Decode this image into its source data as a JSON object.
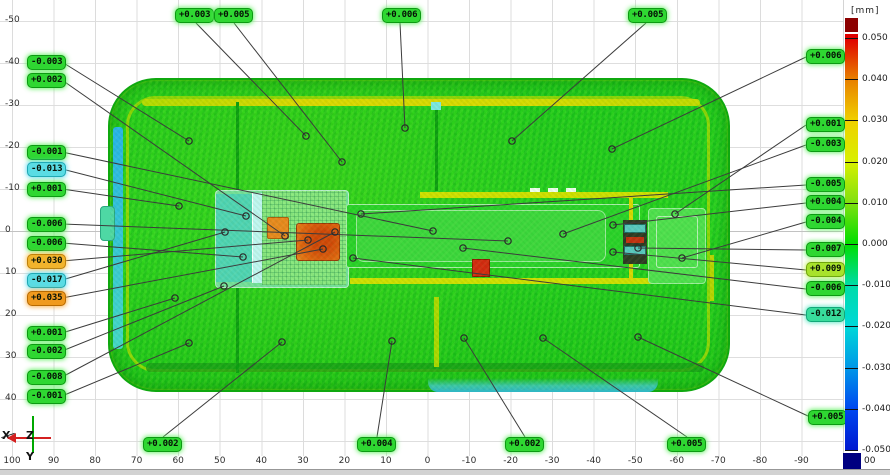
{
  "unit_label": "[mm]",
  "colorbar": {
    "tick_labels": [
      "0.050",
      "0.040",
      "0.030",
      "0.020",
      "0.010",
      "0.000",
      "-0.010",
      "-0.020",
      "-0.030",
      "-0.040",
      "-0.050"
    ],
    "gradient_stops": [
      "#e00000",
      "#e88000",
      "#f0d000",
      "#d8f000",
      "#80e010",
      "#00de00",
      "#00dca8",
      "#00d8d8",
      "#0098e8",
      "#0048f0",
      "#0018d0"
    ],
    "over_color": "#8c0000",
    "under_color": "#000080",
    "under_partial_label": "00"
  },
  "axes": {
    "x_ticks": [
      "100",
      "90",
      "80",
      "70",
      "60",
      "50",
      "40",
      "30",
      "20",
      "10",
      "0",
      "-10",
      "-20",
      "-30",
      "-40",
      "-50",
      "-60",
      "-70",
      "-80",
      "-90"
    ],
    "y_ticks": [
      "-50",
      "-40",
      "-30",
      "-20",
      "-10",
      "0",
      "10",
      "20",
      "30",
      "40"
    ]
  },
  "triad": {
    "x_label": "X",
    "y_label": "Y",
    "z_label": "Z",
    "x_color": "#d42020",
    "y_color": "#00a800"
  },
  "label_colors": {
    "green": "#2fd732",
    "cyan": "#5adce4",
    "teal": "#38dc9c",
    "amber": "#f2b42c",
    "orange": "#f09a1e",
    "lime": "#a8e22c"
  },
  "annotations": [
    {
      "text": "+0.003",
      "c": "green",
      "box": [
        175,
        8
      ],
      "anchor": [
        196,
        23
      ],
      "point": [
        306,
        136
      ]
    },
    {
      "text": "+0.005",
      "c": "green",
      "box": [
        214,
        8
      ],
      "anchor": [
        234,
        23
      ],
      "point": [
        342,
        162
      ]
    },
    {
      "text": "+0.006",
      "c": "green",
      "box": [
        382,
        8
      ],
      "anchor": [
        400,
        23
      ],
      "point": [
        405,
        128
      ]
    },
    {
      "text": "+0.005",
      "c": "green",
      "box": [
        628,
        8
      ],
      "anchor": [
        646,
        23
      ],
      "point": [
        512,
        141
      ]
    },
    {
      "text": "+0.006",
      "c": "green",
      "box": [
        806,
        49
      ],
      "anchor": [
        806,
        57
      ],
      "point": [
        612,
        149
      ]
    },
    {
      "text": "+0.001",
      "c": "green",
      "box": [
        806,
        117
      ],
      "anchor": [
        806,
        125
      ],
      "point": [
        675,
        214
      ]
    },
    {
      "text": "-0.003",
      "c": "green",
      "box": [
        806,
        137
      ],
      "anchor": [
        806,
        145
      ],
      "point": [
        563,
        234
      ]
    },
    {
      "text": "-0.005",
      "c": "green",
      "box": [
        806,
        177
      ],
      "anchor": [
        806,
        185
      ],
      "point": [
        361,
        214
      ]
    },
    {
      "text": "+0.004",
      "c": "green",
      "box": [
        806,
        195
      ],
      "anchor": [
        806,
        203
      ],
      "point": [
        613,
        225
      ]
    },
    {
      "text": "-0.004",
      "c": "green",
      "box": [
        806,
        214
      ],
      "anchor": [
        806,
        222
      ],
      "point": [
        682,
        258
      ]
    },
    {
      "text": "-0.007",
      "c": "green",
      "box": [
        806,
        242
      ],
      "anchor": [
        806,
        250
      ],
      "point": [
        638,
        248
      ]
    },
    {
      "text": "+0.009",
      "c": "lime",
      "box": [
        806,
        262
      ],
      "anchor": [
        806,
        270
      ],
      "point": [
        613,
        252
      ]
    },
    {
      "text": "-0.006",
      "c": "green",
      "box": [
        806,
        281
      ],
      "anchor": [
        806,
        289
      ],
      "point": [
        463,
        248
      ]
    },
    {
      "text": "-0.012",
      "c": "teal",
      "box": [
        806,
        307
      ],
      "anchor": [
        806,
        315
      ],
      "point": [
        353,
        258
      ]
    },
    {
      "text": "+0.005",
      "c": "green",
      "box": [
        808,
        410
      ],
      "anchor": [
        808,
        416
      ],
      "point": [
        638,
        337
      ]
    },
    {
      "text": "-0.003",
      "c": "green",
      "box": [
        27,
        55
      ],
      "anchor": [
        62,
        62
      ],
      "point": [
        189,
        141
      ]
    },
    {
      "text": "+0.002",
      "c": "green",
      "box": [
        27,
        73
      ],
      "anchor": [
        62,
        80
      ],
      "point": [
        285,
        236
      ]
    },
    {
      "text": "-0.001",
      "c": "green",
      "box": [
        27,
        145
      ],
      "anchor": [
        62,
        152
      ],
      "point": [
        433,
        231
      ]
    },
    {
      "text": "-0.013",
      "c": "cyan",
      "box": [
        27,
        162
      ],
      "anchor": [
        62,
        169
      ],
      "point": [
        246,
        216
      ]
    },
    {
      "text": "+0.001",
      "c": "green",
      "box": [
        27,
        182
      ],
      "anchor": [
        62,
        189
      ],
      "point": [
        179,
        206
      ]
    },
    {
      "text": "-0.006",
      "c": "green",
      "box": [
        27,
        217
      ],
      "anchor": [
        62,
        224
      ],
      "point": [
        508,
        241
      ]
    },
    {
      "text": "-0.006",
      "c": "green",
      "box": [
        27,
        236
      ],
      "anchor": [
        62,
        243
      ],
      "point": [
        243,
        257
      ]
    },
    {
      "text": "+0.030",
      "c": "amber",
      "box": [
        27,
        254
      ],
      "anchor": [
        62,
        261
      ],
      "point": [
        308,
        240
      ]
    },
    {
      "text": "-0.017",
      "c": "cyan",
      "box": [
        27,
        273
      ],
      "anchor": [
        62,
        280
      ],
      "point": [
        225,
        232
      ]
    },
    {
      "text": "+0.035",
      "c": "orange",
      "box": [
        27,
        291
      ],
      "anchor": [
        62,
        298
      ],
      "point": [
        323,
        249
      ]
    },
    {
      "text": "+0.001",
      "c": "green",
      "box": [
        27,
        326
      ],
      "anchor": [
        62,
        333
      ],
      "point": [
        175,
        298
      ]
    },
    {
      "text": "-0.002",
      "c": "green",
      "box": [
        27,
        344
      ],
      "anchor": [
        62,
        351
      ],
      "point": [
        224,
        286
      ]
    },
    {
      "text": "-0.008",
      "c": "green",
      "box": [
        27,
        370
      ],
      "anchor": [
        62,
        377
      ],
      "point": [
        335,
        232
      ]
    },
    {
      "text": "-0.001",
      "c": "green",
      "box": [
        27,
        389
      ],
      "anchor": [
        62,
        396
      ],
      "point": [
        189,
        343
      ]
    },
    {
      "text": "+0.002",
      "c": "green",
      "box": [
        143,
        437
      ],
      "anchor": [
        163,
        437
      ],
      "point": [
        282,
        342
      ]
    },
    {
      "text": "+0.004",
      "c": "green",
      "box": [
        357,
        437
      ],
      "anchor": [
        377,
        437
      ],
      "point": [
        392,
        341
      ]
    },
    {
      "text": "+0.002",
      "c": "green",
      "box": [
        505,
        437
      ],
      "anchor": [
        525,
        437
      ],
      "point": [
        464,
        338
      ]
    },
    {
      "text": "+0.005",
      "c": "green",
      "box": [
        667,
        437
      ],
      "anchor": [
        687,
        437
      ],
      "point": [
        543,
        338
      ]
    }
  ]
}
